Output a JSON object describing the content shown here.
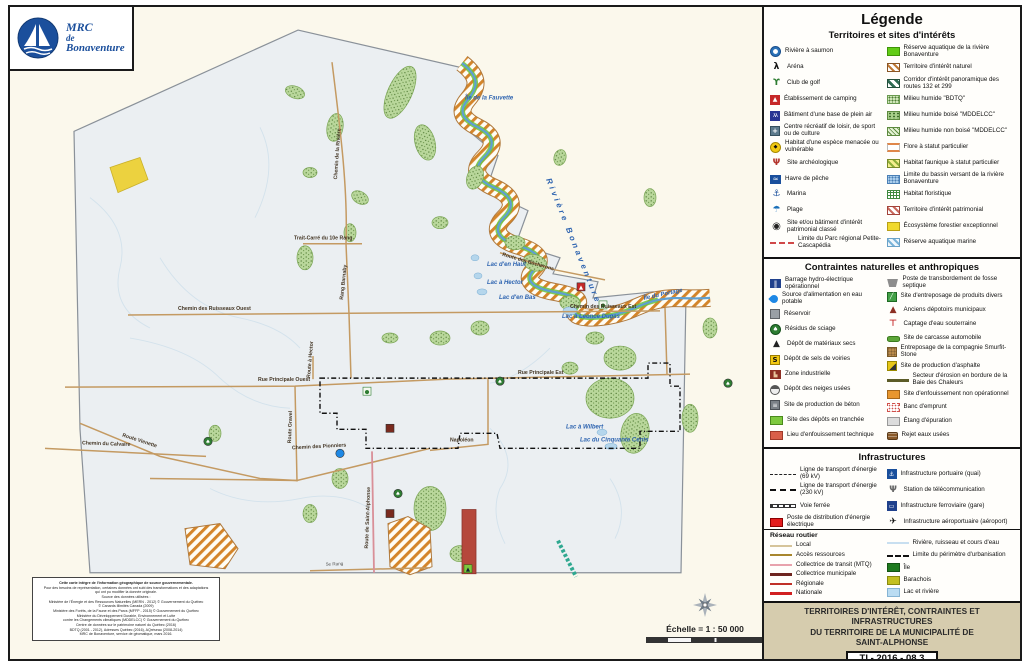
{
  "logo": {
    "line1": "MRC",
    "line2": "de",
    "line3": "Bonaventure"
  },
  "legend": {
    "title": "Légende",
    "territoires": {
      "header": "Territoires et sites d'intérêts",
      "left": [
        {
          "label": "Rivière à saumon",
          "icon": "salmon-river-icon"
        },
        {
          "label": "Aréna",
          "icon": "arena-icon"
        },
        {
          "label": "Club de golf",
          "icon": "golf-icon"
        },
        {
          "label": "Établissement de camping",
          "icon": "camping-icon"
        },
        {
          "label": "Bâtiment d'une base de plein air",
          "icon": "outdoor-base-icon"
        },
        {
          "label": "Centre récréatif de loisir, de sport ou de culture",
          "icon": "recreation-centre-icon"
        },
        {
          "label": "Habitat d'une espèce menacée ou vulnérable",
          "icon": "endangered-habitat-icon"
        },
        {
          "label": "Site archéologique",
          "icon": "archaeological-site-icon"
        },
        {
          "label": "Havre de pêche",
          "icon": "fishing-harbour-icon"
        },
        {
          "label": "Marina",
          "icon": "marina-icon"
        },
        {
          "label": "Plage",
          "icon": "beach-icon"
        },
        {
          "label": "Site et/ou bâtiment d'intérêt patrimonial classé",
          "icon": "heritage-site-icon"
        },
        {
          "label": "Limite du Parc régional Petite-Cascapédia",
          "icon": "cascapedia-park-limit-icon"
        }
      ],
      "right": [
        {
          "label": "Réserve aquatique de la rivière Bonaventure",
          "icon": "bonaventure-aquatic-reserve-swatch"
        },
        {
          "label": "Territoire d'intérêt naturel",
          "icon": "natural-interest-swatch"
        },
        {
          "label": "Corridor d'intérêt panoramique des routes 132 et 299",
          "icon": "panoramic-corridor-swatch"
        },
        {
          "label": "Milieu humide \"BDTQ\"",
          "icon": "wetland-bdtq-swatch"
        },
        {
          "label": "Milieu humide boisé \"MDDELCC\"",
          "icon": "wetland-wooded-swatch"
        },
        {
          "label": "Milieu humide non boisé \"MDDELCC\"",
          "icon": "wetland-open-swatch"
        },
        {
          "label": "Flore à statut particulier",
          "icon": "flora-status-swatch"
        },
        {
          "label": "Habitat faunique à statut particulier",
          "icon": "wildlife-habitat-swatch"
        },
        {
          "label": "Limite du bassin versant de la rivière Bonaventure",
          "icon": "watershed-limit-swatch"
        },
        {
          "label": "Habitat floristique",
          "icon": "floristic-habitat-swatch"
        },
        {
          "label": "Territoire d'intérêt patrimonial",
          "icon": "heritage-territory-swatch"
        },
        {
          "label": "Écosystème forestier exceptionnel",
          "icon": "exceptional-forest-swatch"
        },
        {
          "label": "Réserve aquatique marine",
          "icon": "marine-aquatic-reserve-swatch"
        }
      ]
    },
    "contraintes": {
      "header": "Contraintes naturelles et anthropiques",
      "left": [
        {
          "label": "Barrage hydro-électrique opérationnel",
          "icon": "hydro-dam-icon"
        },
        {
          "label": "Source d'alimentation en eau potable",
          "icon": "drinking-water-source-icon"
        },
        {
          "label": "Réservoir",
          "icon": "reservoir-icon"
        },
        {
          "label": "Résidus de sciage",
          "icon": "sawdust-residue-icon"
        },
        {
          "label": "Dépôt de matériaux secs",
          "icon": "dry-materials-depot-icon"
        },
        {
          "label": "Dépôt de sels de voiries",
          "icon": "road-salt-depot-icon"
        },
        {
          "label": "Zone industrielle",
          "icon": "industrial-zone-icon"
        },
        {
          "label": "Dépôt des neiges usées",
          "icon": "snow-dump-icon"
        },
        {
          "label": "Site de production de béton",
          "icon": "concrete-plant-icon"
        },
        {
          "label": "Site des dépôts en tranchée",
          "icon": "trench-disposal-swatch"
        },
        {
          "label": "Lieu d'enfouissement technique",
          "icon": "technical-landfill-swatch"
        }
      ],
      "right": [
        {
          "label": "Poste de transbordement de fosse septique",
          "icon": "septic-transfer-icon"
        },
        {
          "label": "Site d'entreposage de produits divers",
          "icon": "goods-storage-icon"
        },
        {
          "label": "Anciens dépotoirs municipaux",
          "icon": "old-dump-icon"
        },
        {
          "label": "Captage d'eau souterraine",
          "icon": "groundwater-extraction-icon"
        },
        {
          "label": "Site de carcasse automobile",
          "icon": "car-carcass-icon"
        },
        {
          "label": "Entreposage de la compagnie Smurfit-Stone",
          "icon": "smurfit-storage-icon"
        },
        {
          "label": "Site de production d'asphalte",
          "icon": "asphalt-plant-icon"
        },
        {
          "label": "Secteur d'érosion en bordure de la Baie des Chaleurs",
          "icon": "erosion-sector-icon"
        },
        {
          "label": "Site d'enfouissement non opérationnel",
          "icon": "nonop-landfill-swatch"
        },
        {
          "label": "Banc d'emprunt",
          "icon": "borrow-pit-swatch"
        },
        {
          "label": "Étang d'épuration",
          "icon": "treatment-pond-swatch"
        },
        {
          "label": "Rejet eaux usées",
          "icon": "wastewater-discharge-icon"
        }
      ]
    },
    "infrastructures": {
      "header": "Infrastructures",
      "left": [
        {
          "label": "Ligne de transport d'énergie (69 kV)",
          "icon": "power-line-69kv-icon"
        },
        {
          "label": "Ligne de transport d'énergie (230 kV)",
          "icon": "power-line-230kv-icon"
        },
        {
          "label": "Voie ferrée",
          "icon": "railway-icon"
        },
        {
          "label": "Poste de distribution d'énergie électrique",
          "icon": "power-substation-swatch"
        }
      ],
      "right": [
        {
          "label": "Infrastructure portuaire (quai)",
          "icon": "port-infrastructure-icon"
        },
        {
          "label": "Station de télécommunication",
          "icon": "telecom-station-icon"
        },
        {
          "label": "Infrastructure ferroviaire (gare)",
          "icon": "rail-station-icon"
        },
        {
          "label": "Infrastructure aéroportuaire (aéroport)",
          "icon": "airport-infrastructure-icon"
        }
      ]
    },
    "reseau_routier": {
      "header": "Réseau routier",
      "left": [
        {
          "label": "Local",
          "icon": "local-road-line"
        },
        {
          "label": "Accès ressources",
          "icon": "resource-access-line"
        },
        {
          "label": "Collectrice de transit (MTQ)",
          "icon": "mtq-collector-line"
        },
        {
          "label": "Collectrice municipale",
          "icon": "municipal-collector-line"
        },
        {
          "label": "Régionale",
          "icon": "regional-road-line"
        },
        {
          "label": "Nationale",
          "icon": "national-road-line"
        }
      ],
      "right": [
        {
          "label": "Rivière, ruisseau et cours d'eau",
          "icon": "watercourse-line"
        },
        {
          "label": "Limite du périmètre d'urbanisation",
          "icon": "urban-perimeter-line"
        },
        {
          "label": "Île",
          "icon": "island-swatch"
        },
        {
          "label": "Barachois",
          "icon": "barachois-swatch"
        },
        {
          "label": "Lac et rivière",
          "icon": "lake-river-swatch"
        }
      ]
    }
  },
  "map": {
    "scale_text": "Échelle = 1 : 50 000",
    "labels": [
      {
        "text": "Rivière Bonaventure",
        "x": 536,
        "y": 172,
        "r": 68,
        "cls": "river"
      },
      {
        "text": "Île de la Fauvette",
        "x": 455,
        "y": 92,
        "r": 0,
        "cls": "water"
      },
      {
        "text": "Lac d'en Haut",
        "x": 477,
        "y": 258,
        "r": 0,
        "cls": "water"
      },
      {
        "text": "Lac à Hector",
        "x": 477,
        "y": 276,
        "r": 0,
        "cls": "water"
      },
      {
        "text": "Lac d'en Bas",
        "x": 489,
        "y": 291,
        "r": 0,
        "cls": "water"
      },
      {
        "text": "Lac à Léonce Dugas",
        "x": 552,
        "y": 310,
        "r": 0,
        "cls": "water"
      },
      {
        "text": "Île du Portage",
        "x": 634,
        "y": 292,
        "r": -12,
        "cls": "water"
      },
      {
        "text": "Lac à Wilbert",
        "x": 556,
        "y": 420,
        "r": 0,
        "cls": "water"
      },
      {
        "text": "Lac du Cinquante Cents",
        "x": 570,
        "y": 433,
        "r": 0,
        "cls": "water"
      },
      {
        "text": "Trait-Carré du 10e Rang",
        "x": 284,
        "y": 232,
        "r": 0,
        "cls": "road"
      },
      {
        "text": "Rang Barnaby",
        "x": 333,
        "y": 292,
        "r": -84,
        "cls": "road"
      },
      {
        "text": "Chemin de la Rivière",
        "x": 327,
        "y": 172,
        "r": -86,
        "cls": "road"
      },
      {
        "text": "Chemin des Ruisseaux Ouest",
        "x": 168,
        "y": 302,
        "r": 0,
        "cls": "road"
      },
      {
        "text": "Chemin des Ruisseaux Est",
        "x": 560,
        "y": 300,
        "r": 0,
        "cls": "road"
      },
      {
        "text": "Rue Principale Ouest",
        "x": 248,
        "y": 373,
        "r": 0,
        "cls": "road"
      },
      {
        "text": "Rue Principale Est",
        "x": 508,
        "y": 366,
        "r": 0,
        "cls": "road"
      },
      {
        "text": "Route Gravel",
        "x": 281,
        "y": 435,
        "r": -88,
        "cls": "road"
      },
      {
        "text": "Route à Hector",
        "x": 300,
        "y": 370,
        "r": -85,
        "cls": "road"
      },
      {
        "text": "Route Vienette",
        "x": 112,
        "y": 428,
        "r": 18,
        "cls": "road"
      },
      {
        "text": "Chemin du Calvaire",
        "x": 72,
        "y": 436,
        "r": 2,
        "cls": "road"
      },
      {
        "text": "Chemin des Pionniers",
        "x": 282,
        "y": 441,
        "r": -3,
        "cls": "road"
      },
      {
        "text": "Napoléon",
        "x": 440,
        "y": 433,
        "r": 0,
        "cls": "road"
      },
      {
        "text": "Route de Saint-Alphonse",
        "x": 358,
        "y": 540,
        "r": -88,
        "cls": "road"
      },
      {
        "text": "Route des Bûcherons",
        "x": 492,
        "y": 248,
        "r": 16,
        "cls": "road"
      },
      {
        "text": "5e Rang",
        "x": 316,
        "y": 557,
        "r": -2,
        "cls": "rang"
      }
    ],
    "points": [
      {
        "name": "camping-site-marker",
        "kind": "camping",
        "x": 571,
        "y": 279
      },
      {
        "name": "heritage-site-marker",
        "kind": "heritage",
        "x": 593,
        "y": 297
      },
      {
        "name": "heritage-site-marker",
        "kind": "heritage",
        "x": 357,
        "y": 383
      },
      {
        "name": "sawdust-site-marker",
        "kind": "tree",
        "x": 490,
        "y": 373
      },
      {
        "name": "sawdust-site-marker",
        "kind": "tree",
        "x": 718,
        "y": 375
      },
      {
        "name": "sawdust-site-marker",
        "kind": "tree",
        "x": 388,
        "y": 485
      },
      {
        "name": "sawdust-site-marker",
        "kind": "tree",
        "x": 198,
        "y": 433
      },
      {
        "name": "water-source-marker",
        "kind": "water",
        "x": 330,
        "y": 445
      },
      {
        "name": "industrial-zone-marker",
        "kind": "industry",
        "x": 380,
        "y": 420
      },
      {
        "name": "industrial-zone-marker",
        "kind": "industry",
        "x": 380,
        "y": 505
      },
      {
        "name": "dry-materials-depot-marker",
        "kind": "trench",
        "x": 458,
        "y": 560
      }
    ]
  },
  "title_block": {
    "line1": "TERRITOIRES D'INTÉRÊT, CONTRAINTES ET INFRASTRUCTURES",
    "line2": "DU TERRITOIRE DE LA MUNICIPALITÉ DE",
    "line3": "SAINT-ALPHONSE",
    "code": "TI - 2016 - 08.3"
  },
  "sources": {
    "lines": [
      "Cette carte intègre de l'information géographique de source gouvernementale.",
      "Pour des besoins de représentation, certaines données ont subi des transformations et des adaptations",
      "qui ont pu modifier la donnée originale.",
      "Source des données utilisées :",
      "Ministère de l'Énergie et des Ressources Naturelles (MERN - 2012) © Gouvernement du Québec",
      "© Canards Illimités Canada (2009)",
      "Ministère des Forêts, de la Faune et des Parcs (MFFP - 2015) © Gouvernement du Québec",
      "Ministère du Développement Durable, Environnement et Lutte",
      "contre les Changements climatiques (MDDELCC) © Gouvernement du Québec",
      "Centre de données sur le patrimoine naturel du Québec (2016)",
      "BDTQ (2001 - 2012), Adresses Québec (2016), AQréseau (2008-2014)",
      "MRC de Bonaventure, service de géomatique, mars 2016."
    ]
  }
}
